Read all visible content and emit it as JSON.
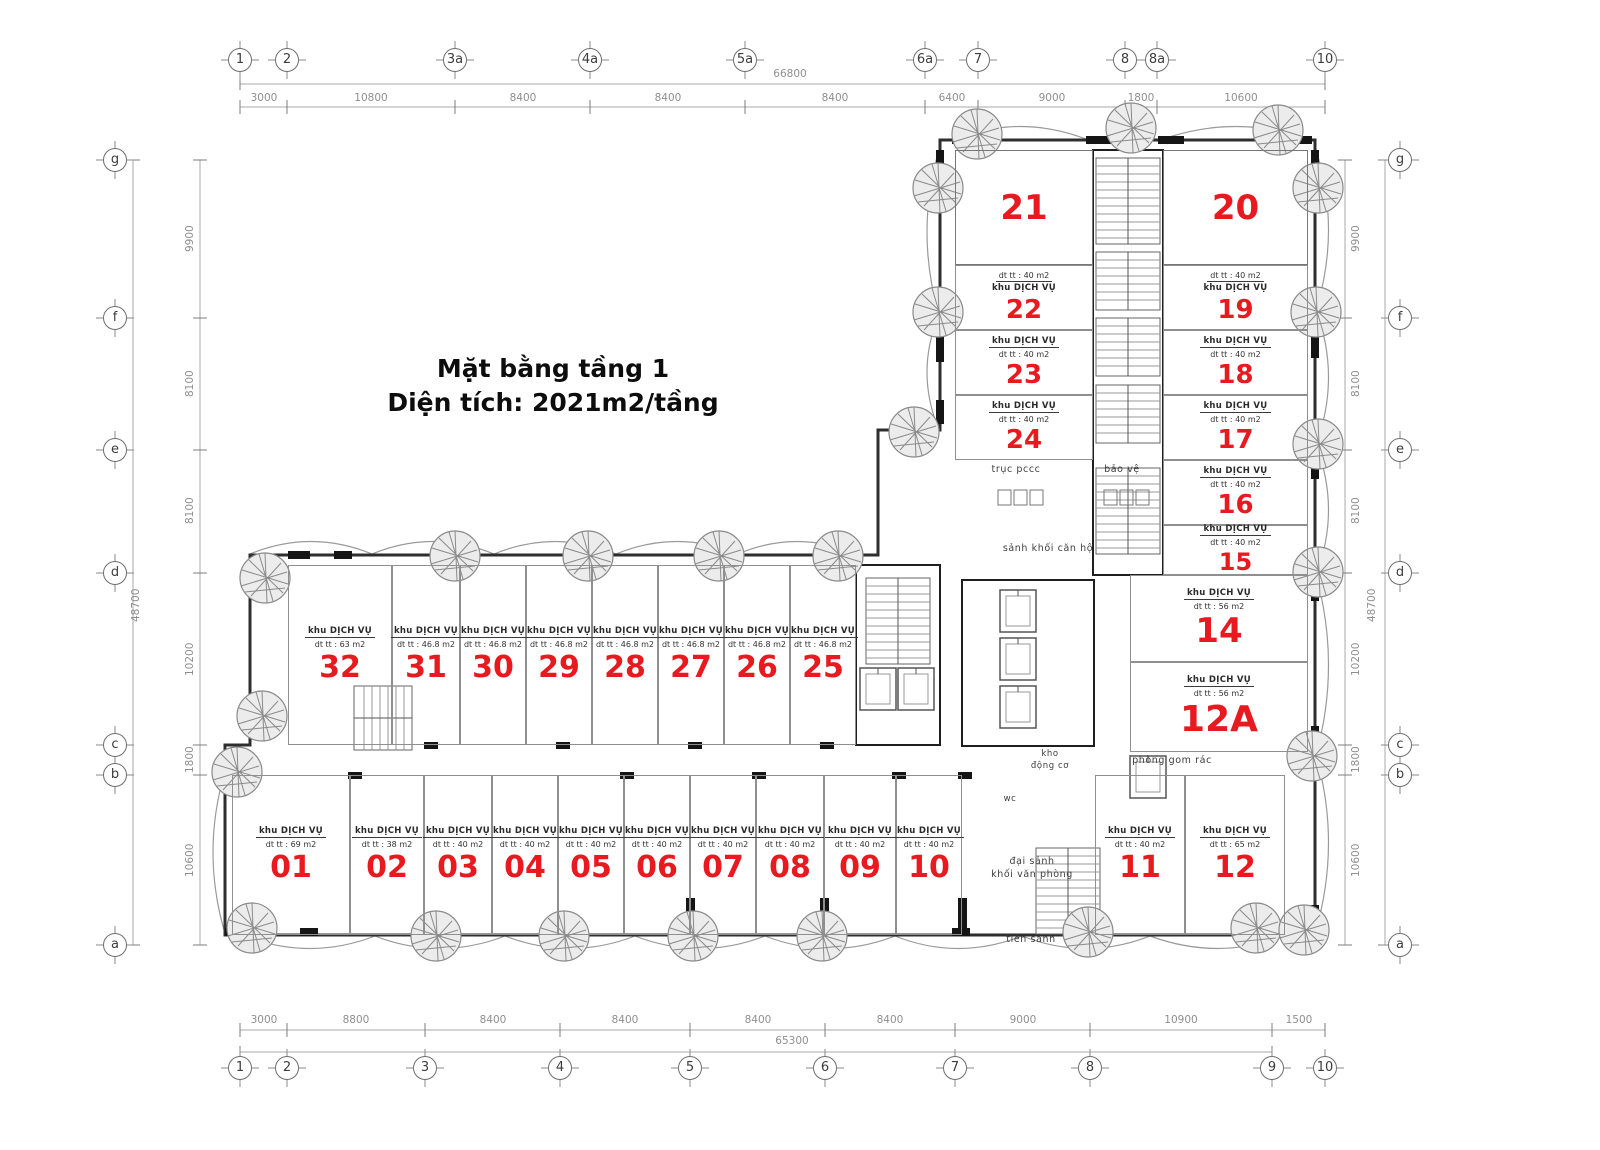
{
  "title": {
    "line1": "Mặt bằng tầng 1",
    "line2": "Diện tích: 2021m2/tầng"
  },
  "colors": {
    "unit_number": "#e8191f",
    "wall": "#2e2e2e",
    "dim_text": "#8f8f8f"
  },
  "grid": {
    "top": {
      "total": "66800",
      "bubbles": [
        "1",
        "2",
        "3a",
        "4a",
        "5a",
        "6a",
        "7",
        "8",
        "8a",
        "10"
      ],
      "dims": [
        "3000",
        "10800",
        "8400",
        "8400",
        "8400",
        "6400",
        "9000",
        "1800",
        "10600"
      ]
    },
    "bottom": {
      "total": "65300",
      "bubbles": [
        "1",
        "2",
        "3",
        "4",
        "5",
        "6",
        "7",
        "8",
        "9",
        "10"
      ],
      "dims": [
        "3000",
        "8800",
        "8400",
        "8400",
        "8400",
        "8400",
        "9000",
        "10900",
        "1500"
      ]
    },
    "left": {
      "total": "48700",
      "bubbles": [
        "g",
        "f",
        "e",
        "d",
        "c",
        "b",
        "a"
      ],
      "dims": [
        "9900",
        "8100",
        "8100",
        "10200",
        "1800",
        "10600"
      ]
    },
    "right": {
      "total": "48700",
      "bubbles": [
        "g",
        "f",
        "e",
        "d",
        "c",
        "b",
        "a"
      ],
      "dims": [
        "9900",
        "8100",
        "8100",
        "10200",
        "1800",
        "10600"
      ]
    }
  },
  "units": {
    "01": {
      "number": "01",
      "label": "khu DỊCH VỤ",
      "area": "dt tt : 69 m2"
    },
    "02": {
      "number": "02",
      "label": "khu DỊCH VỤ",
      "area": "dt tt : 38 m2"
    },
    "03": {
      "number": "03",
      "label": "khu DỊCH VỤ",
      "area": "dt tt : 40 m2"
    },
    "04": {
      "number": "04",
      "label": "khu DỊCH VỤ",
      "area": "dt tt : 40 m2"
    },
    "05": {
      "number": "05",
      "label": "khu DỊCH VỤ",
      "area": "dt tt : 40 m2"
    },
    "06": {
      "number": "06",
      "label": "khu DỊCH VỤ",
      "area": "dt tt : 40 m2"
    },
    "07": {
      "number": "07",
      "label": "khu DỊCH VỤ",
      "area": "dt tt : 40 m2"
    },
    "08": {
      "number": "08",
      "label": "khu DỊCH VỤ",
      "area": "dt tt : 40 m2"
    },
    "09": {
      "number": "09",
      "label": "khu DỊCH VỤ",
      "area": "dt tt : 40 m2"
    },
    "10": {
      "number": "10",
      "label": "khu DỊCH VỤ",
      "area": "dt tt : 40 m2"
    },
    "11": {
      "number": "11",
      "label": "khu DỊCH VỤ",
      "area": "dt tt : 40 m2"
    },
    "12": {
      "number": "12",
      "label": "khu DỊCH VỤ",
      "area": "dt tt : 65 m2"
    },
    "12A": {
      "number": "12A",
      "label": "khu DỊCH VỤ",
      "area": "dt tt : 56 m2"
    },
    "14": {
      "number": "14",
      "label": "khu DỊCH VỤ",
      "area": "dt tt : 56 m2"
    },
    "15": {
      "number": "15",
      "label": "khu DỊCH VỤ",
      "area": "dt tt : 40 m2"
    },
    "16": {
      "number": "16",
      "label": "khu DỊCH VỤ",
      "area": "dt tt : 40 m2"
    },
    "17": {
      "number": "17",
      "label": "khu DỊCH VỤ",
      "area": "dt tt : 40 m2"
    },
    "18": {
      "number": "18",
      "label": "khu DỊCH VỤ",
      "area": "dt tt : 40 m2"
    },
    "19": {
      "number": "19",
      "label": "khu DỊCH VỤ",
      "area": "dt tt : 40 m2"
    },
    "20": {
      "number": "20",
      "label": "",
      "area": ""
    },
    "21": {
      "number": "21",
      "label": "",
      "area": ""
    },
    "22": {
      "number": "22",
      "label": "khu DỊCH VỤ",
      "area": "dt tt : 40 m2"
    },
    "23": {
      "number": "23",
      "label": "khu DỊCH VỤ",
      "area": "dt tt : 40 m2"
    },
    "24": {
      "number": "24",
      "label": "khu DỊCH VỤ",
      "area": "dt tt : 40 m2"
    },
    "25": {
      "number": "25",
      "label": "khu DỊCH VỤ",
      "area": "dt tt : 46.8 m2"
    },
    "26": {
      "number": "26",
      "label": "khu DỊCH VỤ",
      "area": "dt tt : 46.8 m2"
    },
    "27": {
      "number": "27",
      "label": "khu DỊCH VỤ",
      "area": "dt tt : 46.8 m2"
    },
    "28": {
      "number": "28",
      "label": "khu DỊCH VỤ",
      "area": "dt tt : 46.8 m2"
    },
    "29": {
      "number": "29",
      "label": "khu DỊCH VỤ",
      "area": "dt tt : 46.8 m2"
    },
    "30": {
      "number": "30",
      "label": "khu DỊCH VỤ",
      "area": "dt tt : 46.8 m2"
    },
    "31": {
      "number": "31",
      "label": "khu DỊCH VỤ",
      "area": "dt tt : 46.8 m2"
    },
    "32": {
      "number": "32",
      "label": "khu DỊCH VỤ",
      "area": "dt tt : 63 m2"
    }
  },
  "rooms": {
    "truc_pccc": "trục pccc",
    "bao_ve": "bảo vệ",
    "sanh_khoi_can_ho": "sảnh khối căn hộ",
    "kho_1": "kho",
    "kho_2": "động cơ",
    "phong_gom_rac": "phòng gom rác",
    "wc": "wc",
    "dai_sanh_1": "đại sảnh",
    "dai_sanh_2": "khối văn phòng",
    "tien_sanh": "tiền sảnh"
  }
}
